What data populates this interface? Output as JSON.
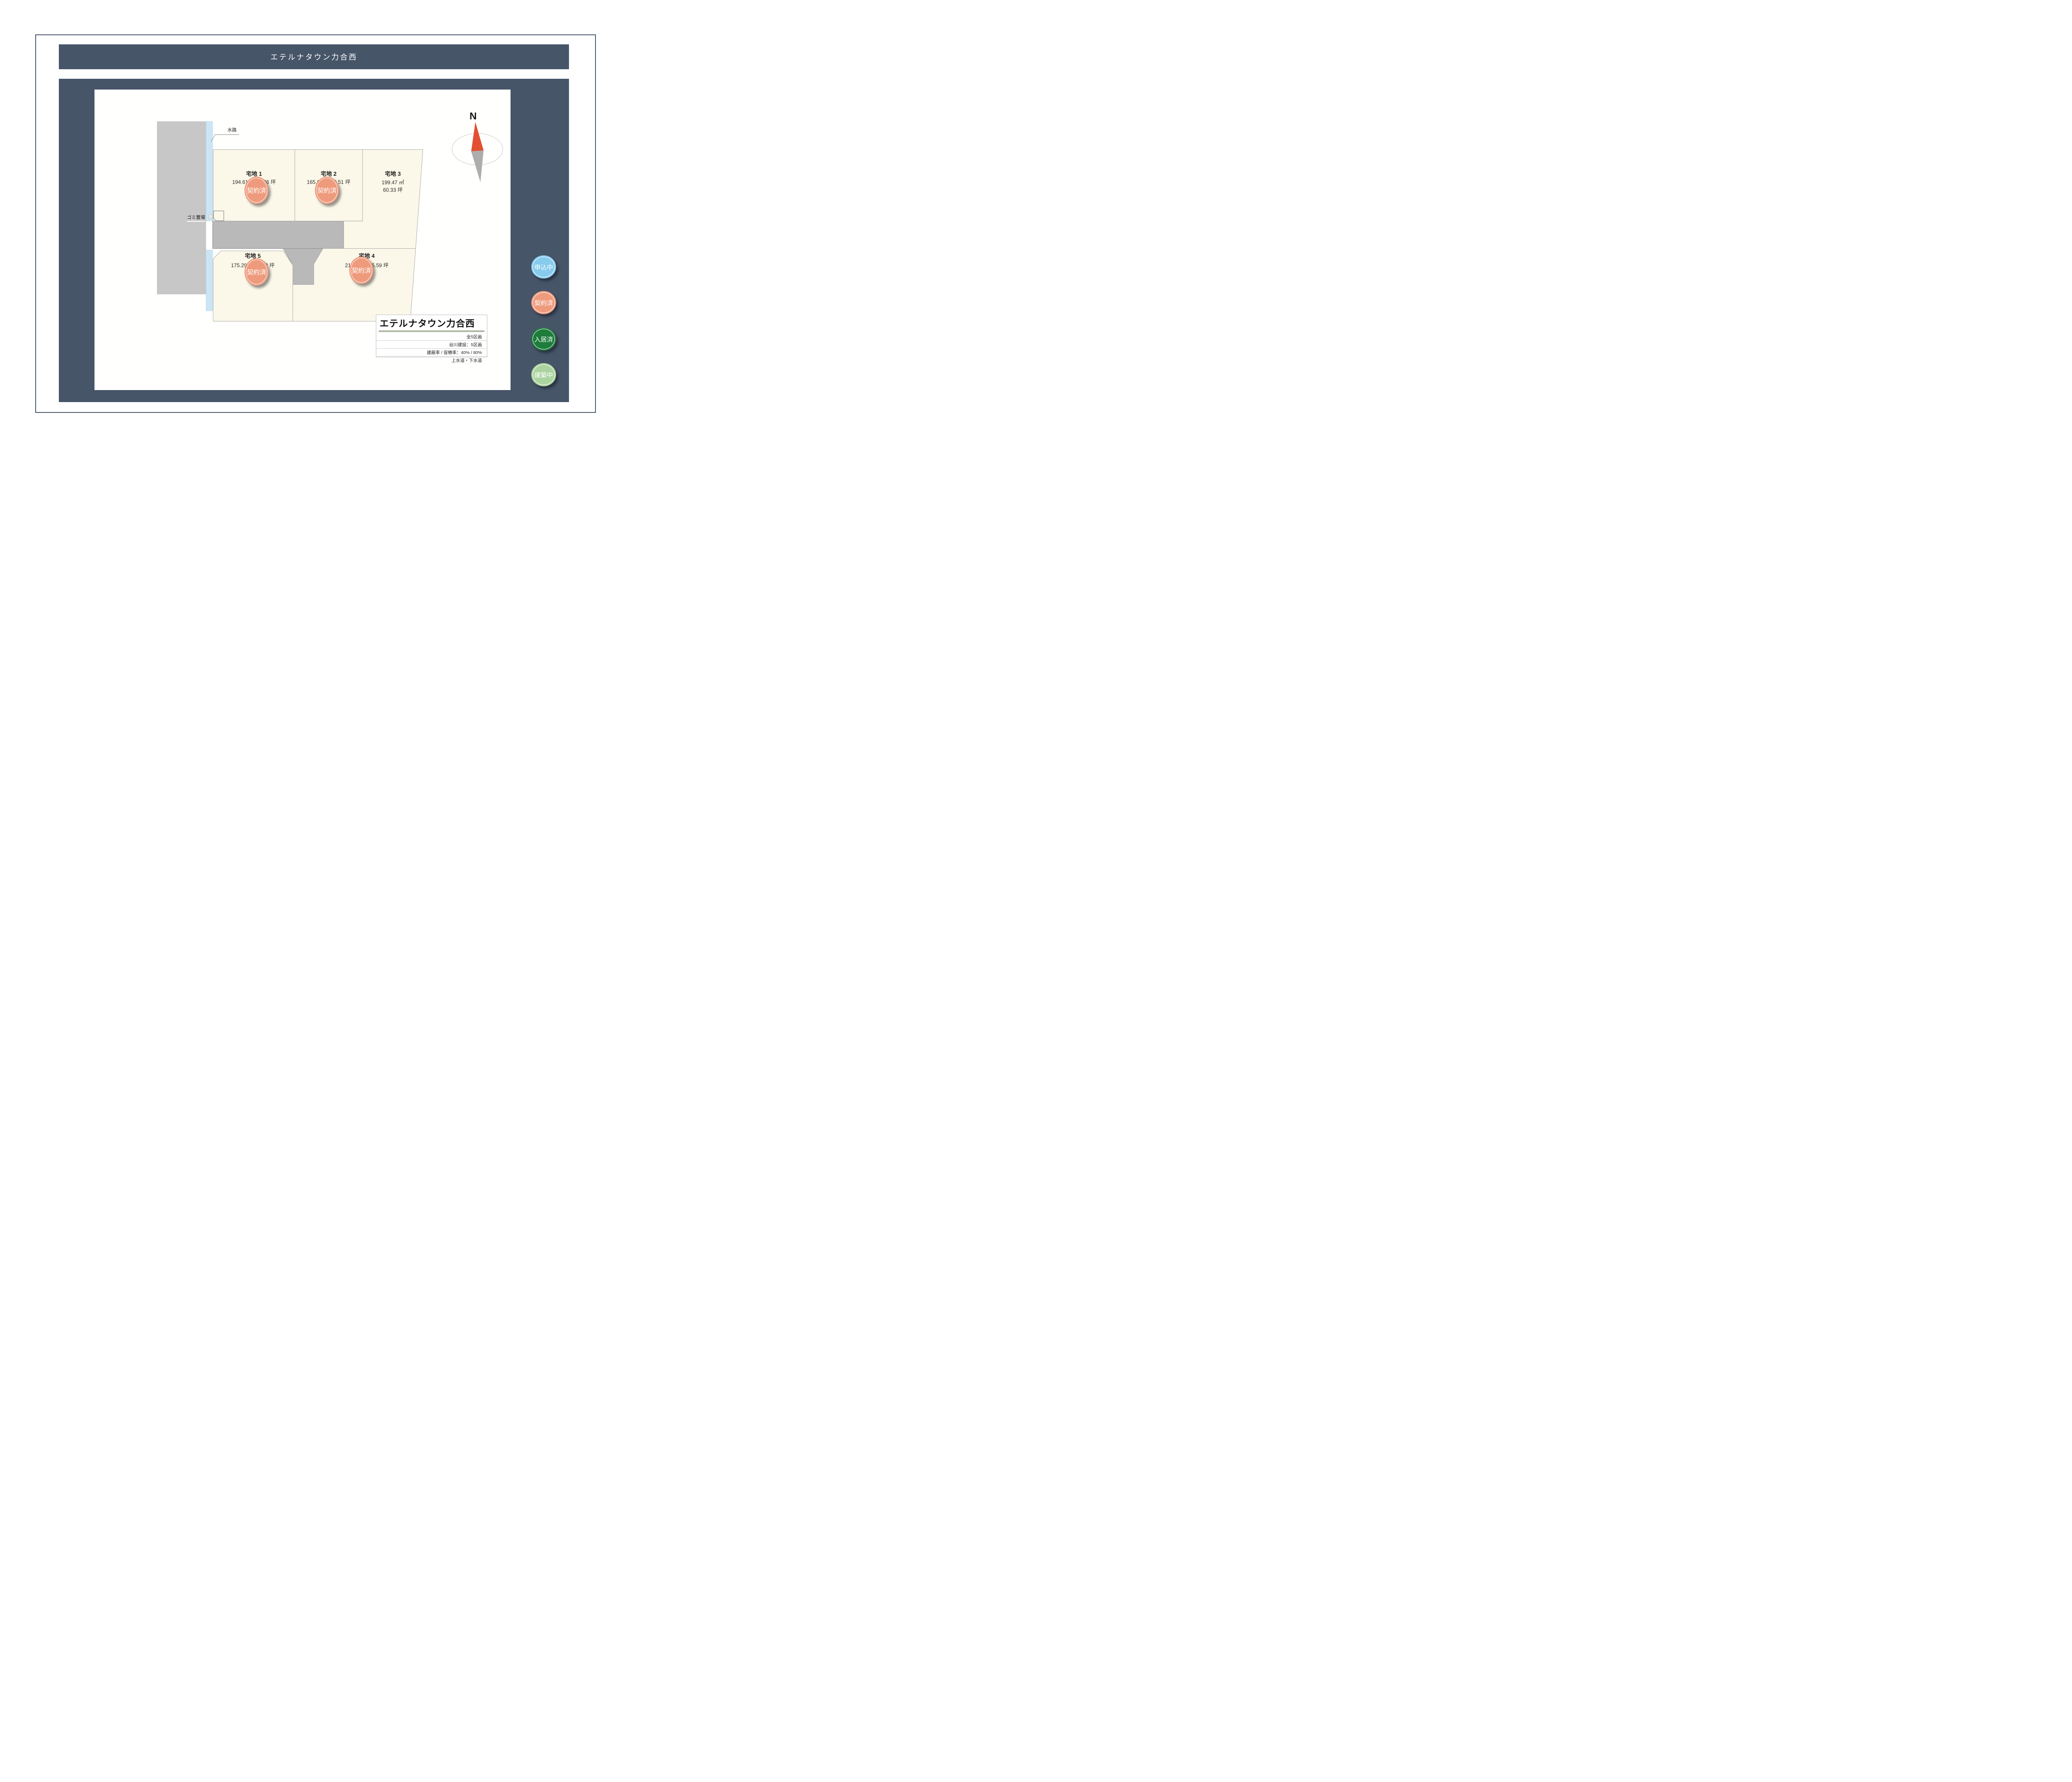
{
  "header": {
    "title": "エテルナタウン力合西"
  },
  "map": {
    "waterway_label": "水路",
    "garbage_label": "ゴミ置場",
    "compass_label": "N",
    "lots": [
      {
        "id": "1",
        "name": "宅地 1",
        "area_m2": "194.61 ㎡",
        "area_tsubo": "58.86 坪",
        "status": "契約済"
      },
      {
        "id": "2",
        "name": "宅地 2",
        "area_m2": "165.69 ㎡",
        "area_tsubo": "50.51 坪",
        "status": "契約済"
      },
      {
        "id": "3",
        "name": "宅地 3",
        "area_m2": "199.47 ㎡",
        "area_tsubo": "60.33 坪",
        "status": ""
      },
      {
        "id": "4",
        "name": "宅地 4",
        "area_m2": "216.85 ㎡",
        "area_tsubo": "65.59 坪",
        "status": "契約済"
      },
      {
        "id": "5",
        "name": "宅地 5",
        "area_m2": "175.29 ㎡",
        "area_tsubo": "53.02 坪",
        "status": "契約済"
      }
    ]
  },
  "info_box": {
    "title": "エテルナタウン力合西",
    "rows": [
      "全5区画",
      "谷川建設：5区画",
      "建蔽率 / 容積率：40% / 80%",
      "上水道・下水道"
    ]
  },
  "legend": [
    {
      "label": "申込中",
      "color": "#87cbed",
      "text_color": "#ffffff"
    },
    {
      "label": "契約済",
      "color": "#ee9a7c",
      "text_color": "#ffffff"
    },
    {
      "label": "入居済",
      "color": "#1e7c3c",
      "text_color": "#ffffff"
    },
    {
      "label": "建築中",
      "color": "#abd3a0",
      "text_color": "#ffffff"
    }
  ],
  "colors": {
    "navy": "#475569",
    "lot_fill": "#fbf8e9",
    "lot_stroke": "#a9a9a9",
    "road_fill": "#b9b9b9",
    "road_stroke": "#8f8f8f",
    "block_fill": "#c7c7c7",
    "water_fill": "#cbe5f5",
    "contracted": "#ee9a7c",
    "compass_red": "#e34f33",
    "compass_gray": "#adadad",
    "info_bar": "#aeb9a4"
  }
}
